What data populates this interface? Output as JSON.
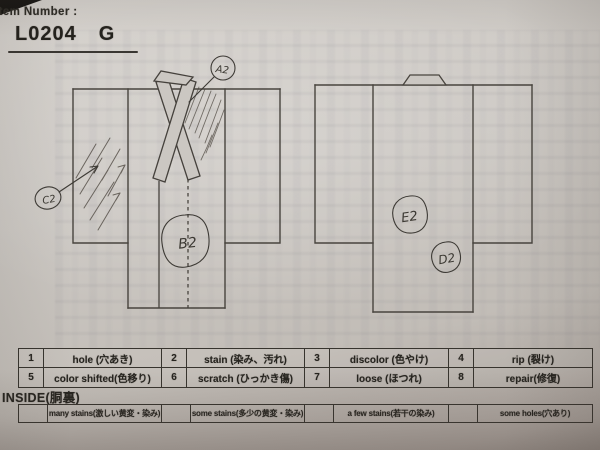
{
  "header": {
    "item_number_label": "Item Number :",
    "item_number_value": "L0204",
    "item_number_suffix": "G"
  },
  "annotations": {
    "front_collar": "A2",
    "front_sleeve": "C2",
    "front_center": "B2",
    "back_center": "E2",
    "back_lower": "D2"
  },
  "defect_codes": [
    {
      "code": "1",
      "label": "hole (穴あき)"
    },
    {
      "code": "2",
      "label": "stain (染み、汚れ)"
    },
    {
      "code": "3",
      "label": "discolor (色やけ)"
    },
    {
      "code": "4",
      "label": "rip (裂け)"
    },
    {
      "code": "5",
      "label": "color shifted(色移り)"
    },
    {
      "code": "6",
      "label": "scratch (ひっかき傷)"
    },
    {
      "code": "7",
      "label": "loose (ほつれ)"
    },
    {
      "code": "8",
      "label": "repair(修復)"
    }
  ],
  "inside": {
    "title": "INSIDE(胴裏)",
    "options": [
      {
        "label": "many stains(激しい黄変・染み)"
      },
      {
        "label": "some stains(多少の黄変・染み)"
      },
      {
        "label": "a few stains(若干の染み)"
      },
      {
        "label": "some holes(穴あり)"
      }
    ]
  },
  "colors": {
    "paper": "#cbc7c2",
    "ink": "#45413c",
    "text": "#26241f"
  }
}
